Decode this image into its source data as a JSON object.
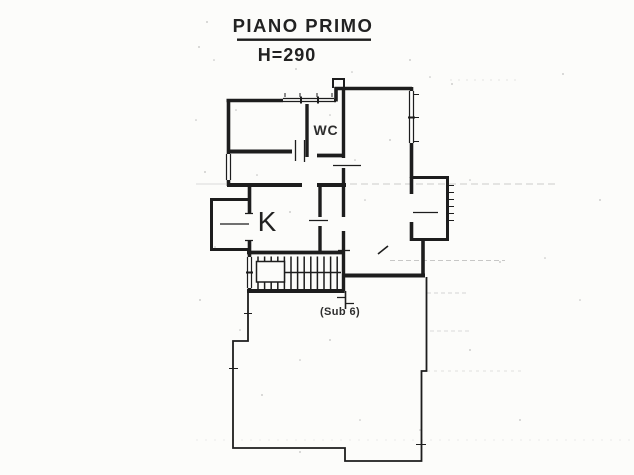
{
  "sheet": {
    "title": "PIANO PRIMO",
    "height_label": "H=290",
    "room_labels": {
      "wc": "WC",
      "kitchen": "K"
    },
    "unit_annotation": "(Sub 6)",
    "colors": {
      "paper": "#fcfcfa",
      "ink": "#1d1d1d",
      "scan_artifact": "#9a9a9a"
    }
  }
}
